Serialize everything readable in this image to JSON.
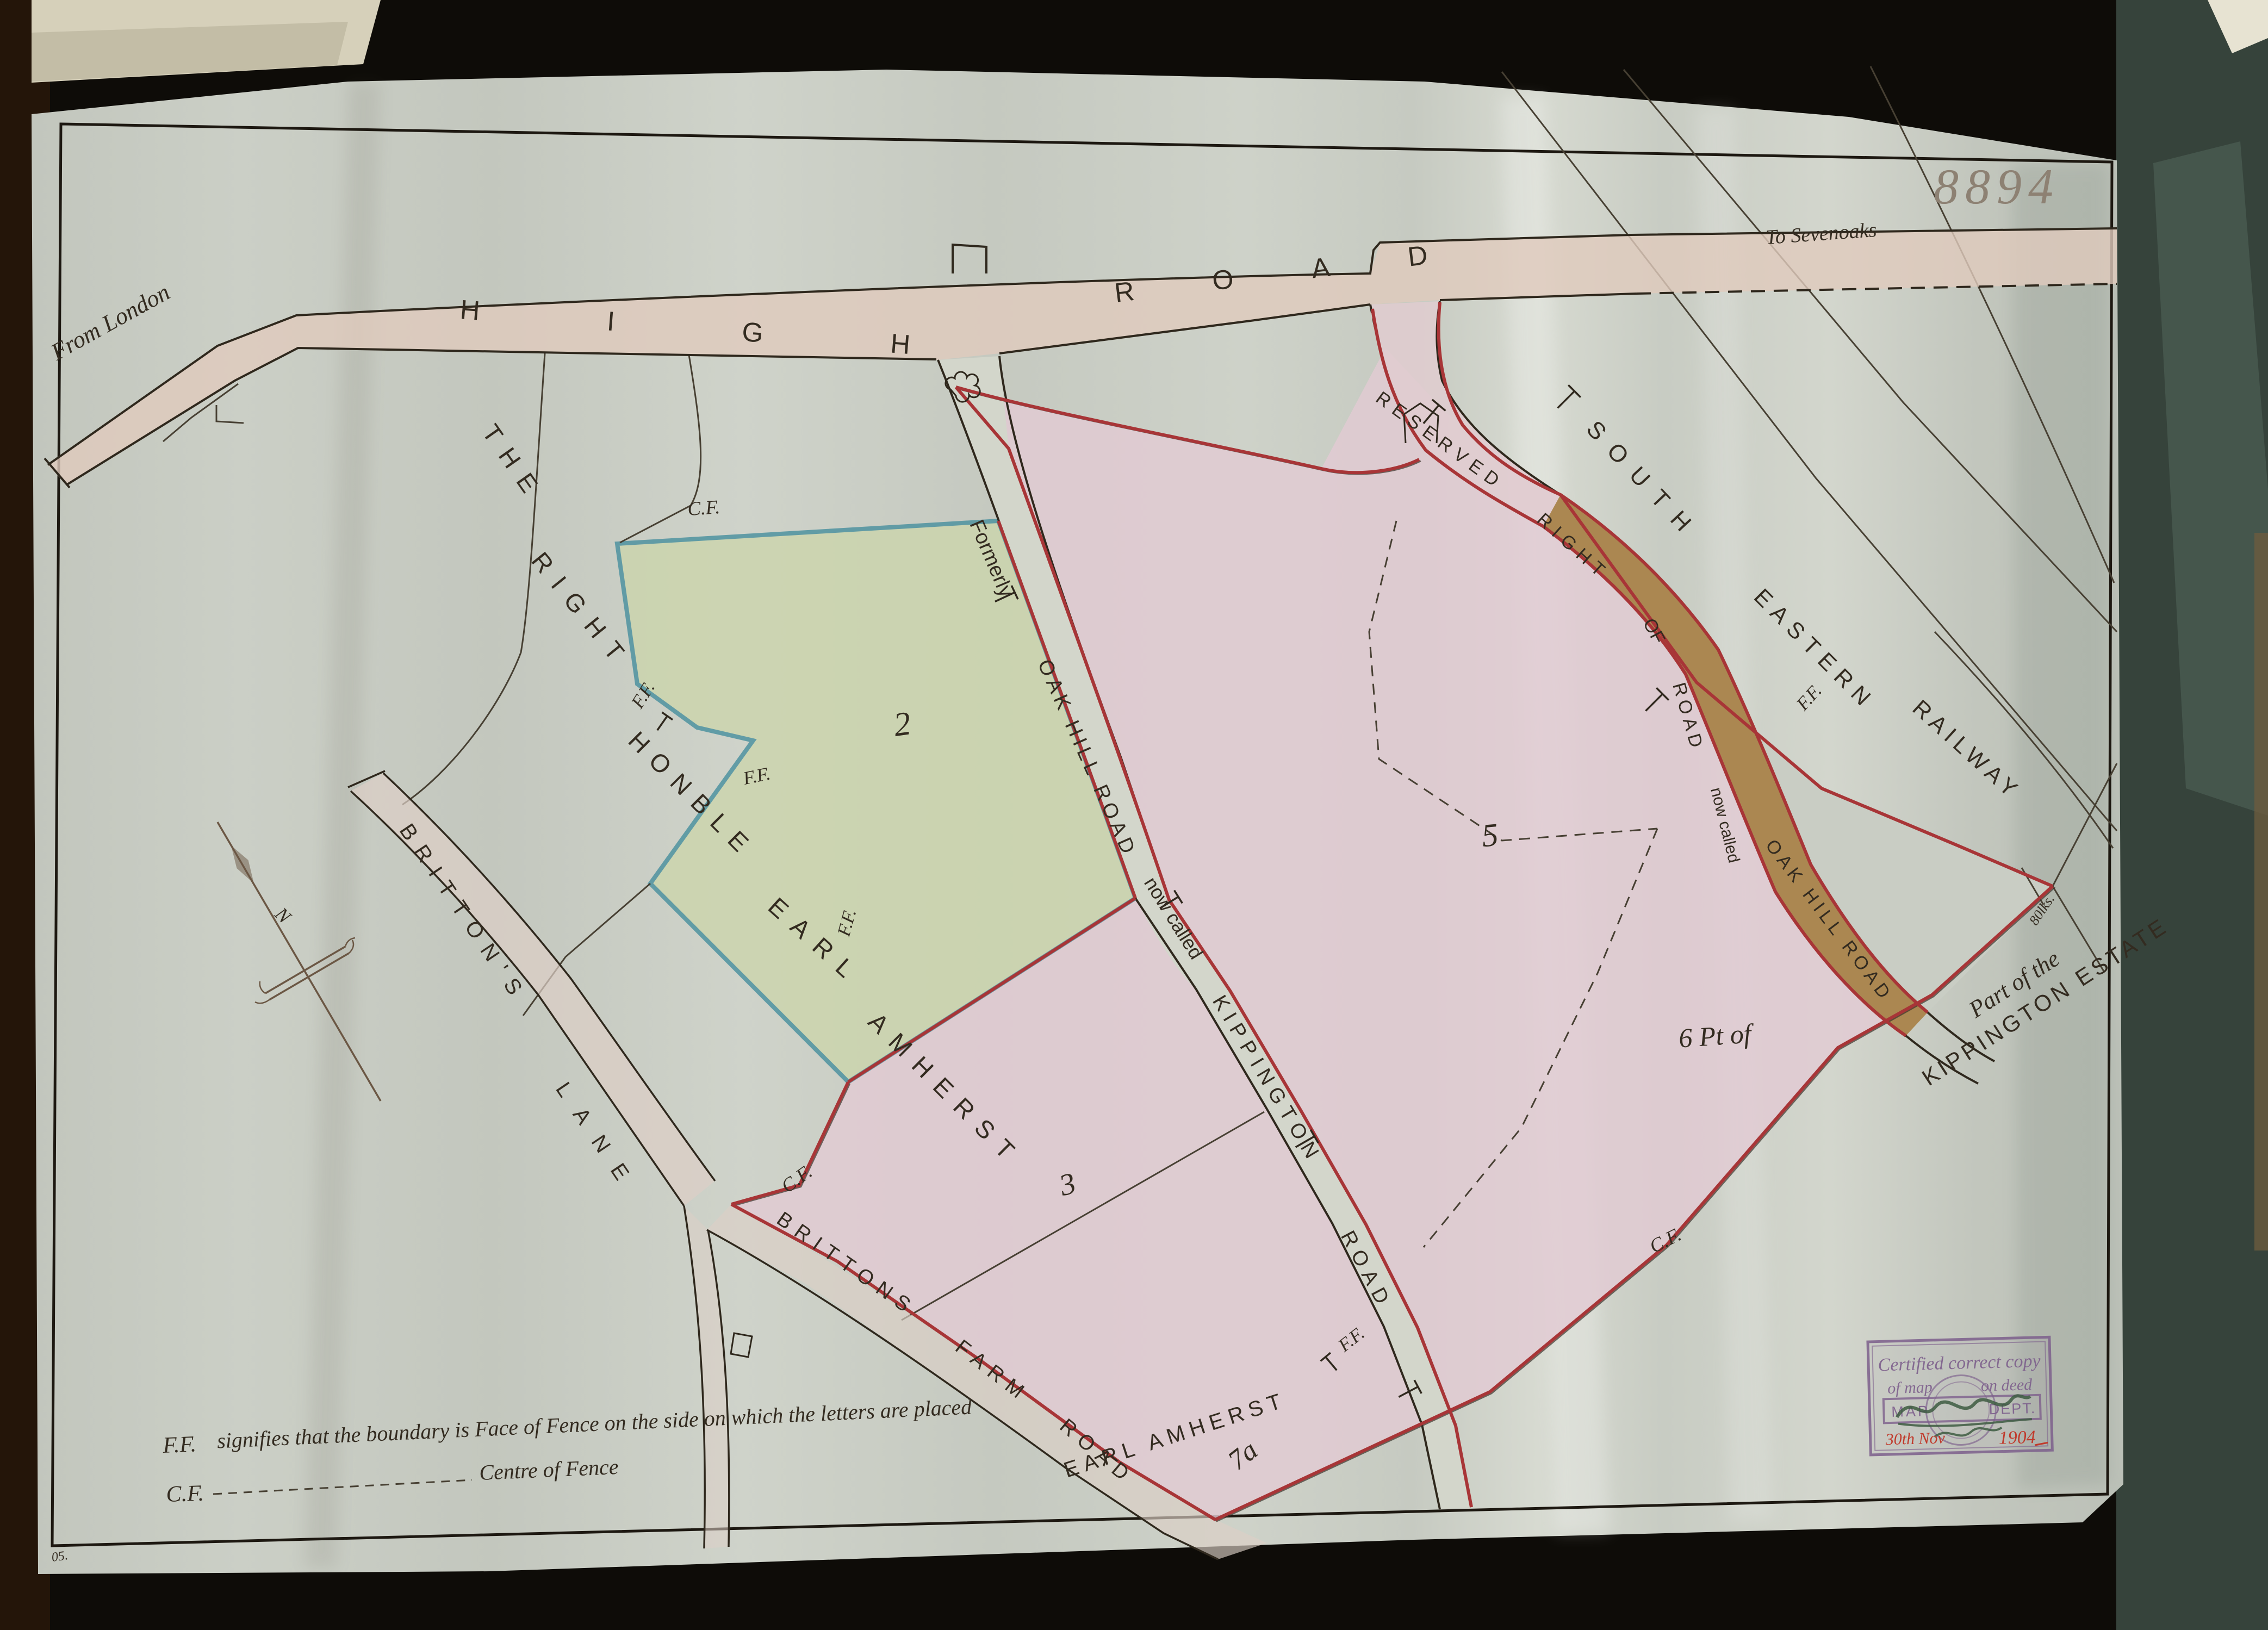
{
  "sheet": {
    "number": "8894",
    "corner_note": "05."
  },
  "directions": {
    "from": "From London",
    "to": "To Sevenoaks"
  },
  "roads": {
    "high": {
      "words": [
        "HIGH",
        "ROAD"
      ]
    },
    "oak_hill_former": {
      "prefix": "Formerly",
      "name": "OAK HILL ROAD",
      "suffix": "now called"
    },
    "kippington": {
      "words": [
        "KIPPINGTON",
        "ROAD"
      ]
    },
    "reserved": {
      "words": [
        "RESERVED",
        "RIGHT",
        "OF",
        "ROAD"
      ],
      "suffix": "now called",
      "name": "OAK HILL ROAD"
    },
    "brittons_lane": {
      "words": [
        "BRITTON'S",
        "LANE"
      ]
    },
    "brittons_farm": {
      "words": [
        "BRITTONS",
        "FARM",
        "ROAD"
      ]
    }
  },
  "railway": {
    "words": [
      "SOUTH",
      "EASTERN",
      "RAILWAY"
    ]
  },
  "owners": {
    "right_honble": {
      "words": [
        "THE",
        "RIGHT",
        "HONBLE",
        "EARL",
        "AMHERST"
      ]
    },
    "earl_amherst": "EARL AMHERST"
  },
  "estate": {
    "line1": "Part of the",
    "line2": "KIPPINGTON ESTATE",
    "measure": "80lks."
  },
  "parcels": {
    "p2": "2",
    "p3": "3",
    "p5": "5",
    "p6": "6 Pt of",
    "p7a": "7a"
  },
  "marks": {
    "ff": "F.F.",
    "cf": "C.F."
  },
  "compass": {
    "north": "N"
  },
  "legend": {
    "ff_abbr": "F.F.",
    "ff_text": "signifies that the boundary is Face of Fence on the side on which the letters are placed",
    "cf_abbr": "C.F.",
    "cf_text": "Centre of Fence"
  },
  "stamp": {
    "line1": "Certified correct copy",
    "of_map": "of map",
    "on_deed": "on deed",
    "map": "MAP",
    "dept": "DEPT.",
    "date_day": "30th Nov",
    "date_year": "1904"
  },
  "colors": {
    "parcel_pink": "#e2cbd3",
    "parcel_green": "#ccd5ae",
    "road_wash_pink": "#e0cabd",
    "road_brown": "#ab8751",
    "boundary_red": "#a83537",
    "boundary_teal": "#4f93a0",
    "stamp_purple": "#7d5f8c",
    "stamp_date_red": "#c03a2c"
  }
}
